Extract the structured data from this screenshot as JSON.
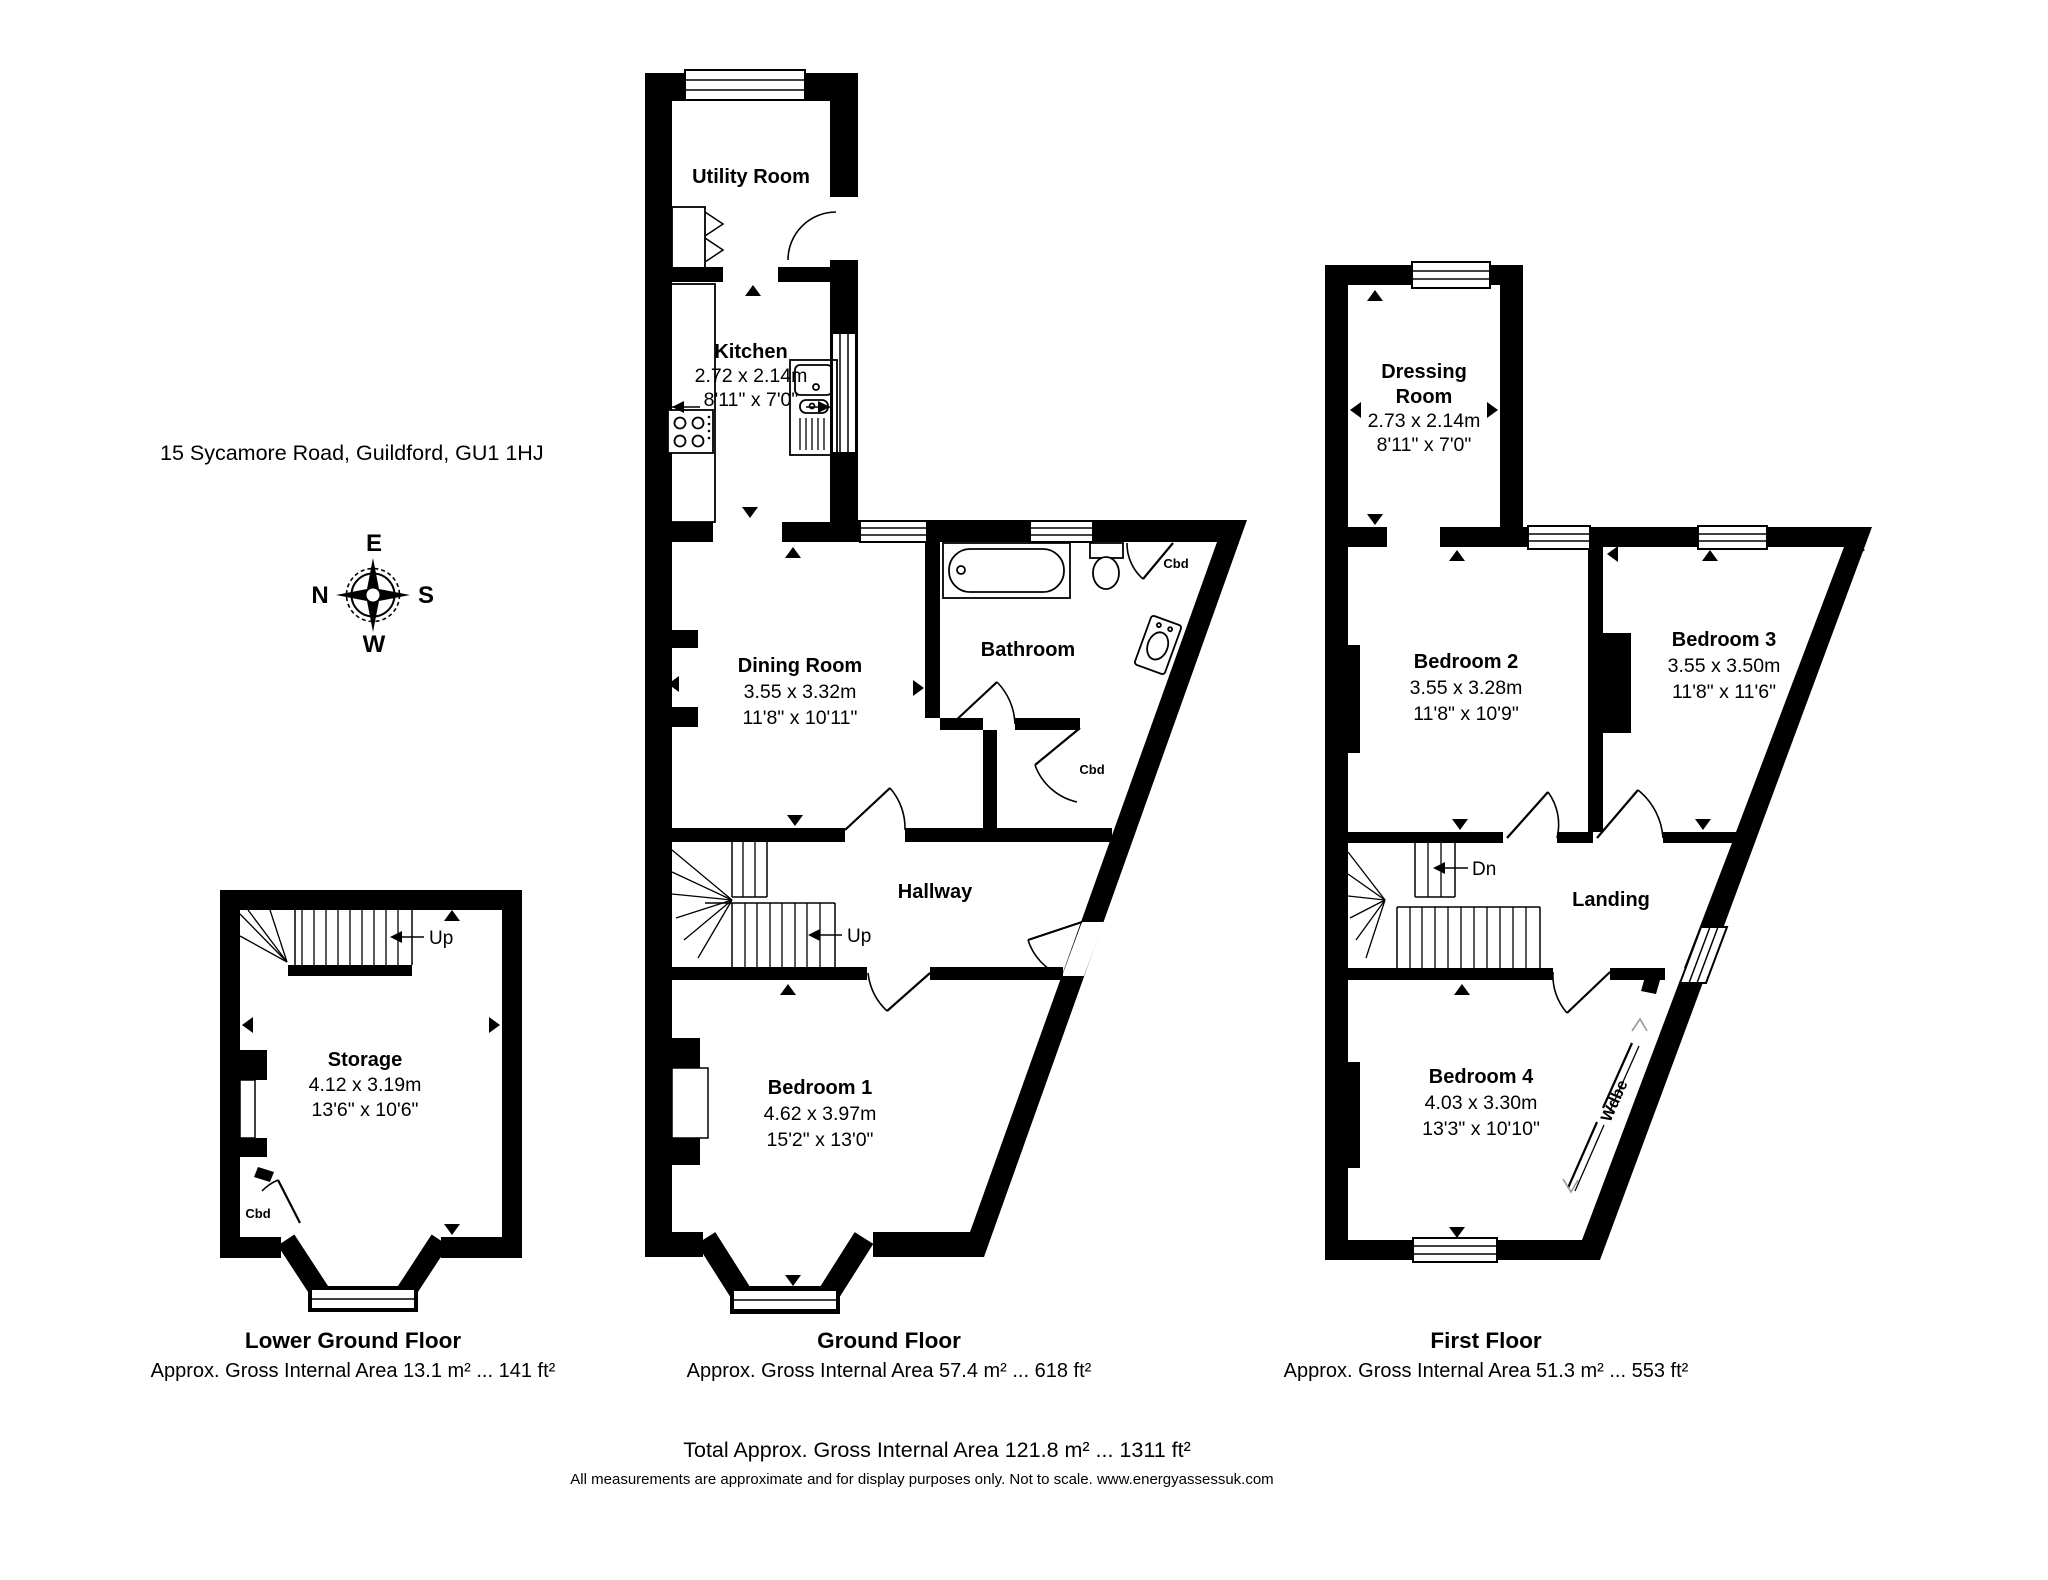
{
  "header": {
    "address": "15 Sycamore Road, Guildford, GU1 1HJ"
  },
  "compass": {
    "top": "E",
    "left": "N",
    "right": "S",
    "bottom": "W"
  },
  "floors": {
    "lower_ground": {
      "title": "Lower Ground Floor",
      "area": "Approx. Gross Internal Area 13.1 m² ... 141 ft²",
      "stairs": "Up",
      "rooms": {
        "storage": {
          "name": "Storage",
          "metric": "4.12 x 3.19m",
          "imperial": "13'6\" x 10'6\""
        },
        "cbd": {
          "name": "Cbd"
        }
      }
    },
    "ground": {
      "title": "Ground Floor",
      "area": "Approx. Gross Internal Area 57.4 m² ... 618 ft²",
      "stairs": "Up",
      "rooms": {
        "utility": {
          "name": "Utility Room"
        },
        "kitchen": {
          "name": "Kitchen",
          "metric": "2.72 x 2.14m",
          "imperial": "8'11\" x 7'0\""
        },
        "dining": {
          "name": "Dining Room",
          "metric": "3.55 x 3.32m",
          "imperial": "11'8\" x 10'11\""
        },
        "bathroom": {
          "name": "Bathroom"
        },
        "cbd_corner": {
          "name": "Cbd"
        },
        "cbd": {
          "name": "Cbd"
        },
        "hallway": {
          "name": "Hallway"
        },
        "bedroom1": {
          "name": "Bedroom 1",
          "metric": "4.62 x 3.97m",
          "imperial": "15'2\" x 13'0\""
        }
      }
    },
    "first": {
      "title": "First Floor",
      "area": "Approx. Gross Internal Area 51.3 m² ... 553 ft²",
      "stairs": "Dn",
      "rooms": {
        "dressing": {
          "name_line1": "Dressing",
          "name_line2": "Room",
          "metric": "2.73 x 2.14m",
          "imperial": "8'11\" x 7'0\""
        },
        "bedroom2": {
          "name": "Bedroom 2",
          "metric": "3.55 x 3.28m",
          "imperial": "11'8\" x 10'9\""
        },
        "bedroom3": {
          "name": "Bedroom 3",
          "metric": "3.55 x 3.50m",
          "imperial": "11'8\" x 11'6\""
        },
        "landing": {
          "name": "Landing"
        },
        "bedroom4": {
          "name": "Bedroom 4",
          "metric": "4.03 x 3.30m",
          "imperial": "13'3\" x 10'10\""
        },
        "wardrobe": {
          "name": "Wdbe"
        }
      }
    }
  },
  "footer": {
    "total": "Total Approx. Gross Internal Area 121.8 m² ... 1311 ft²",
    "disclaimer": "All measurements are approximate and for display purposes only. Not to scale. www.energyassessuk.com"
  }
}
